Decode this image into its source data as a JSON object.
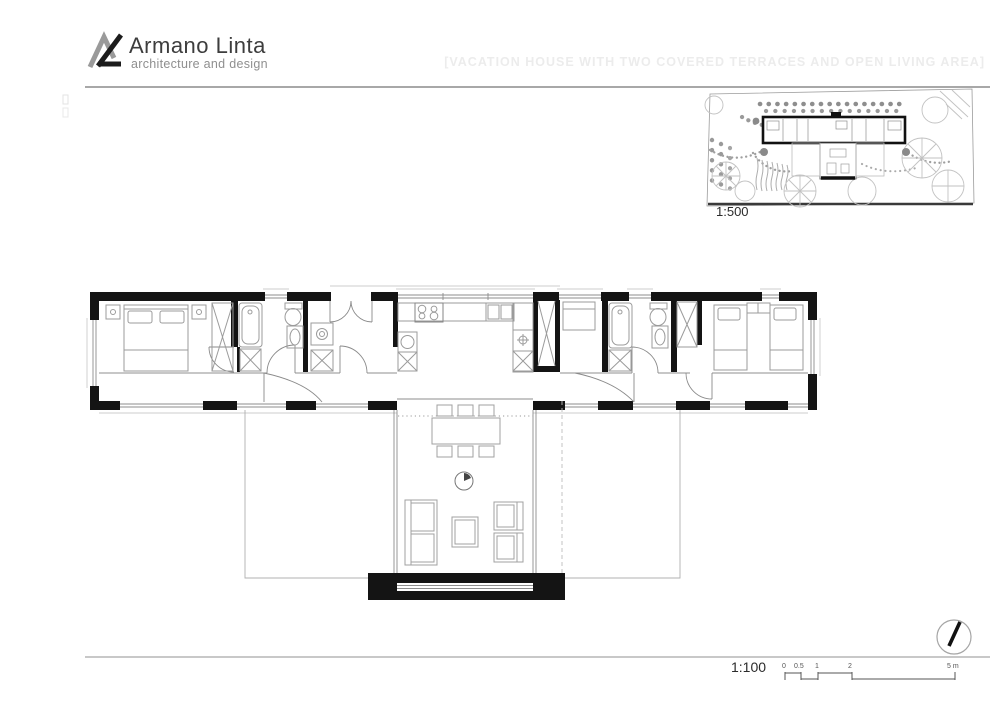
{
  "header": {
    "brand": "Armano Linta",
    "tagline": "architecture and design",
    "watermark": "[VACATION HOUSE WITH TWO COVERED TERRACES AND OPEN LIVING AREA]"
  },
  "site_plan": {
    "scale_label": "1:500"
  },
  "floor_plan": {
    "scale_label": "1:100"
  },
  "scale_bar": {
    "ticks": [
      "0",
      "0.5",
      "1",
      "2",
      "5 m"
    ]
  },
  "icons": [
    "armano-linta-logo-icon",
    "north-indicator-icon"
  ],
  "colors": {
    "wall_black": "#141414",
    "furniture_gray": "#999999",
    "light_line": "#bbbbbb",
    "rule_gray": "#a8a8a8",
    "watermark_gray": "#ececec"
  }
}
